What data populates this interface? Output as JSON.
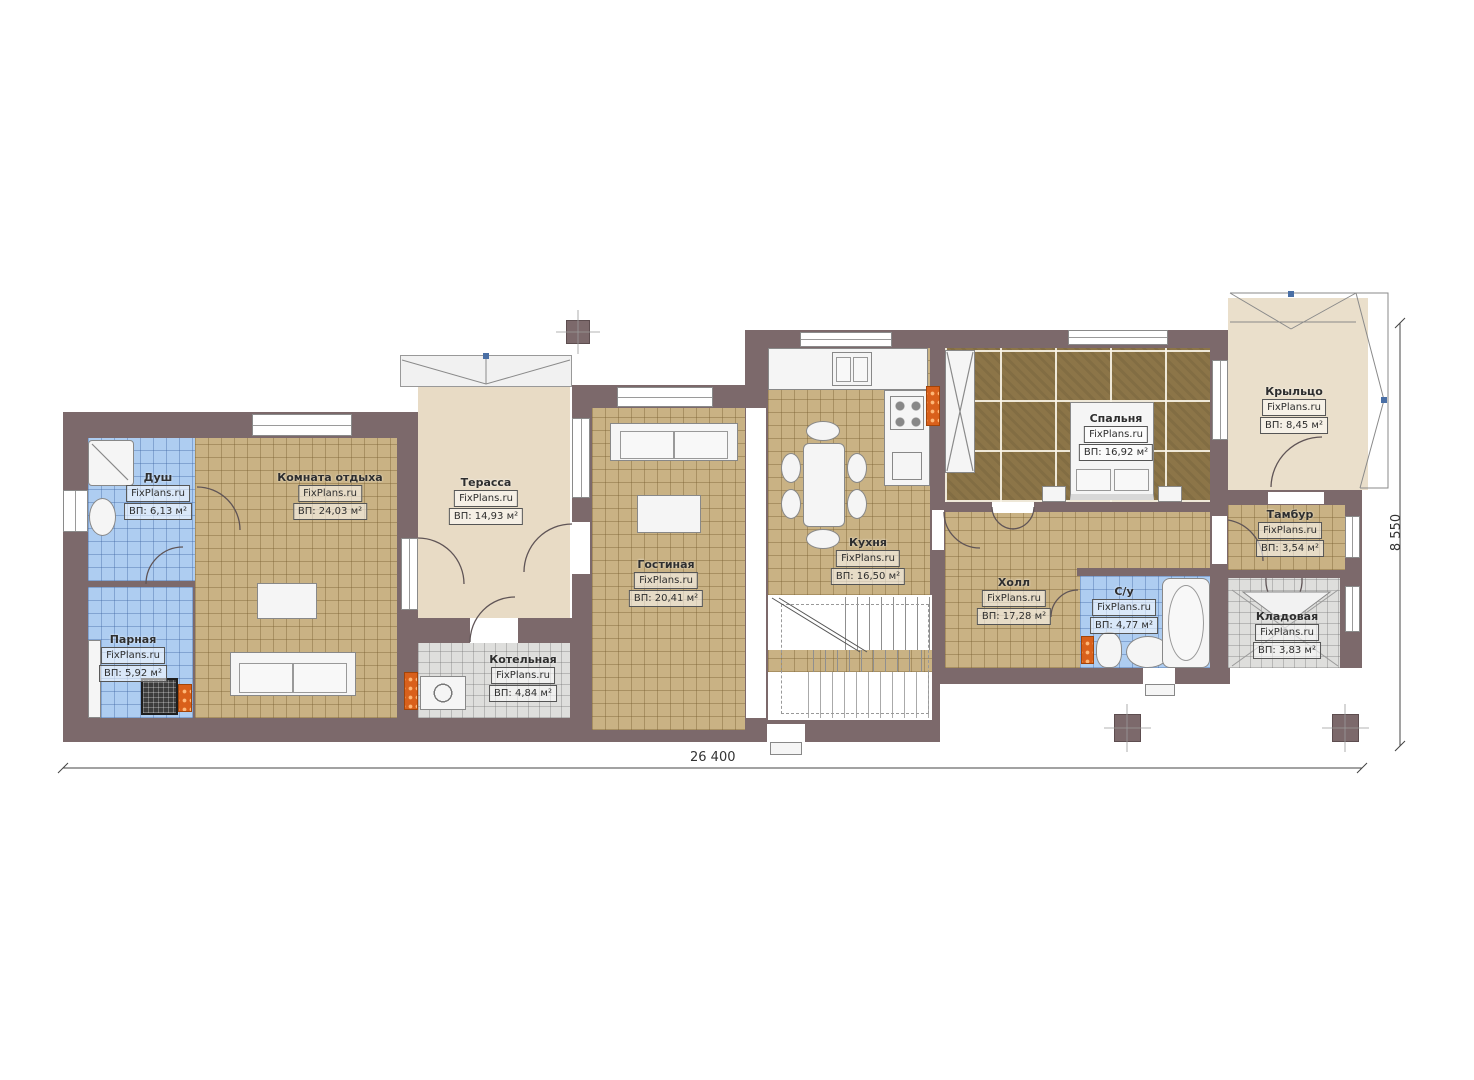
{
  "watermark": "FixPlans.ru",
  "dimensions": {
    "bottom": "26 400",
    "right": "8 550"
  },
  "colors": {
    "wall": "#7c696b",
    "tile_blue": "#aecdf1",
    "tile_tan": "#c9b284",
    "tile_gray": "#dededc",
    "wood_floor": "#8c7548",
    "terrace_beige": "#e8dbc5",
    "radiator_orange": "#d9601b"
  },
  "rooms": [
    {
      "name": "Душ",
      "watermark": "FixPlans.ru",
      "area": "ВП: 6,13 м²"
    },
    {
      "name": "Парная",
      "watermark": "FixPlans.ru",
      "area": "ВП: 5,92 м²"
    },
    {
      "name": "Комната отдыха",
      "watermark": "FixPlans.ru",
      "area": "ВП: 24,03 м²"
    },
    {
      "name": "Терасса",
      "watermark": "FixPlans.ru",
      "area": "ВП: 14,93 м²"
    },
    {
      "name": "Котельная",
      "watermark": "FixPlans.ru",
      "area": "ВП: 4,84 м²"
    },
    {
      "name": "Гостиная",
      "watermark": "FixPlans.ru",
      "area": "ВП: 20,41 м²"
    },
    {
      "name": "Кухня",
      "watermark": "FixPlans.ru",
      "area": "ВП: 16,50 м²"
    },
    {
      "name": "Спальня",
      "watermark": "FixPlans.ru",
      "area": "ВП: 16,92 м²"
    },
    {
      "name": "Холл",
      "watermark": "FixPlans.ru",
      "area": "ВП: 17,28 м²"
    },
    {
      "name": "С/у",
      "watermark": "FixPlans.ru",
      "area": "ВП: 4,77 м²"
    },
    {
      "name": "Тамбур",
      "watermark": "FixPlans.ru",
      "area": "ВП: 3,54 м²"
    },
    {
      "name": "Кладовая",
      "watermark": "FixPlans.ru",
      "area": "ВП: 3,83 м²"
    },
    {
      "name": "Крыльцо",
      "watermark": "FixPlans.ru",
      "area": "ВП: 8,45 м²"
    }
  ]
}
